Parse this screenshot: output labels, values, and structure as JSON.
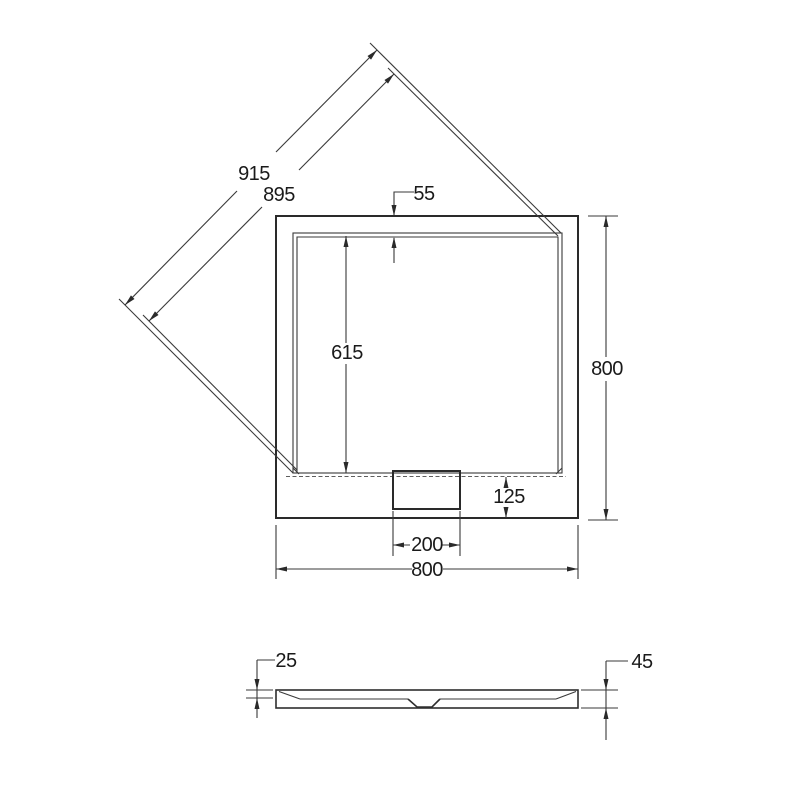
{
  "drawing": {
    "background_color": "#ffffff",
    "line_color": "#3a3a3a",
    "text_color": "#1a1a1a",
    "plan_view": {
      "diagonal_outer_label": "915",
      "diagonal_inner_label": "895",
      "top_rim_label": "55",
      "basin_length_label": "615",
      "side_height_label": "800",
      "drain_bottom_offset_label": "125",
      "drain_width_label": "200",
      "bottom_width_label": "800"
    },
    "side_view": {
      "basin_depth_label": "25",
      "total_height_label": "45"
    }
  }
}
